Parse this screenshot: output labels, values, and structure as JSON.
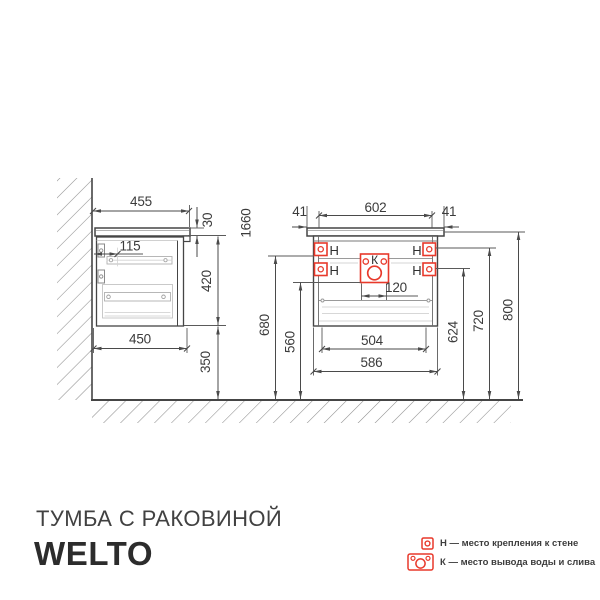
{
  "dims": {
    "side": {
      "width_top": "455",
      "counter_thickness": "30",
      "back_offset": "115",
      "body_height": "420",
      "width_bottom": "450",
      "floor_gap": "350",
      "total_height": "1660"
    },
    "front": {
      "overhang_left": "41",
      "width_top": "602",
      "overhang_right": "41",
      "drain_width": "120",
      "inner_width": "504",
      "body_width": "586",
      "drain_height": "560",
      "mount_low_height": "624",
      "mount_mid_height": "680",
      "mount_high_height": "720",
      "counter_height": "800"
    }
  },
  "markers": {
    "mount": "Н",
    "drain": "К"
  },
  "branding": {
    "product": "ТУМБА С РАКОВИНОЙ",
    "brand": "WELTO"
  },
  "legend": {
    "mount": "Н — место крепления к стене",
    "drain": "К — место вывода воды и слива"
  },
  "colors": {
    "accent_red": "#e8392b",
    "line": "#4a4a4a"
  }
}
